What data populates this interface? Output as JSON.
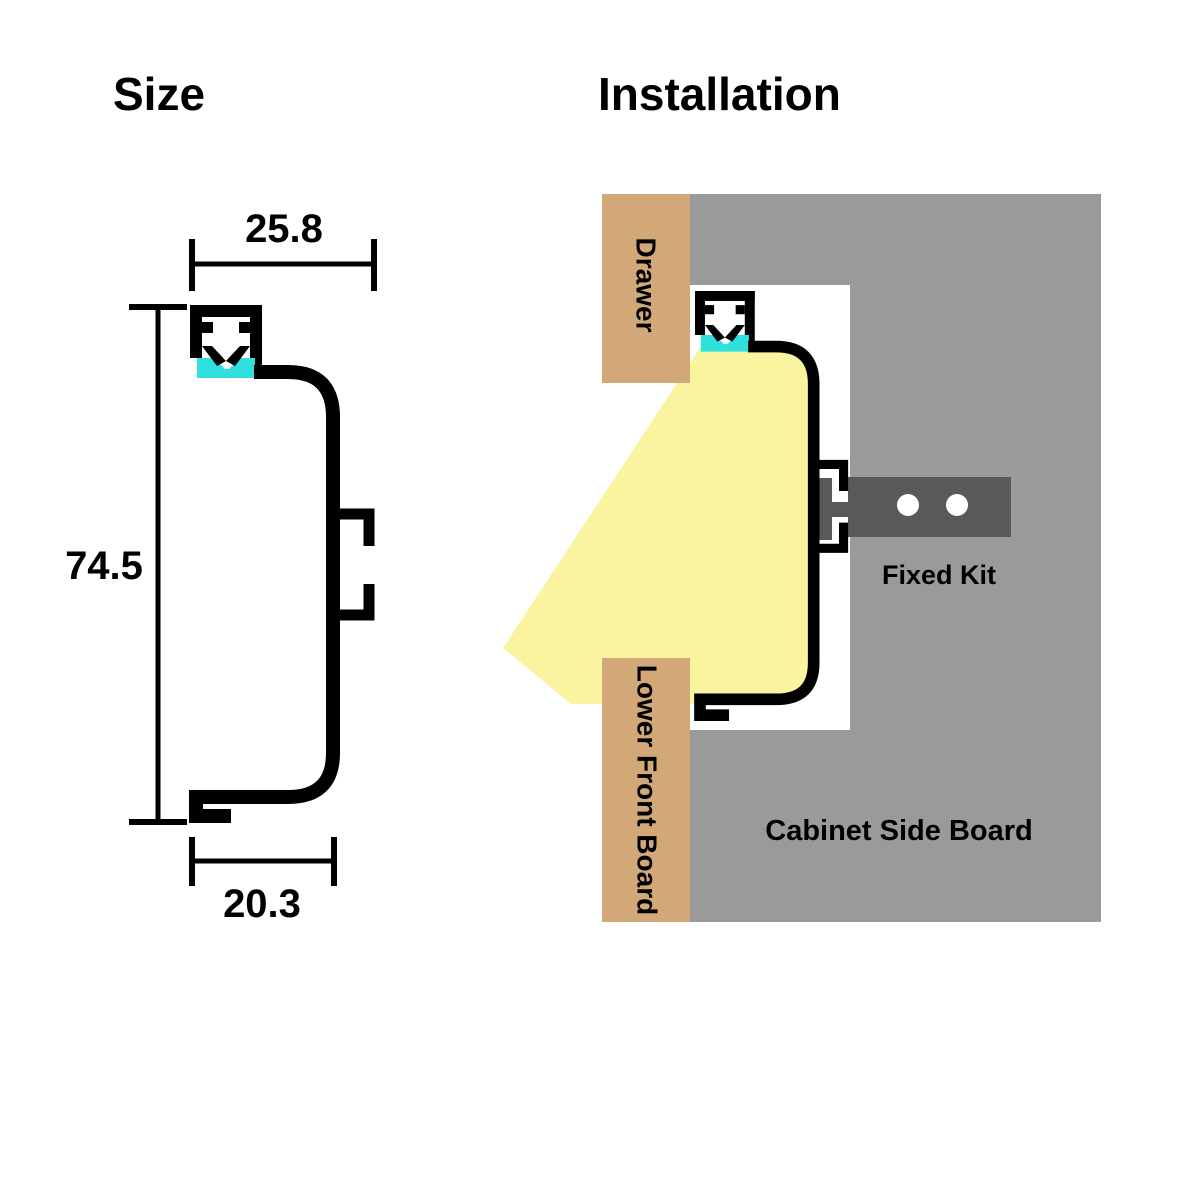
{
  "size_panel": {
    "title": "Size",
    "dim_top": "25.8",
    "dim_left": "74.5",
    "dim_bottom": "20.3"
  },
  "installation_panel": {
    "title": "Installation",
    "drawer_label": "Drawer",
    "fixed_kit_label": "Fixed Kit",
    "lower_front_board_label": "Lower Front Board",
    "cabinet_side_board_label": "Cabinet Side Board"
  },
  "colors": {
    "profile_outline": "#000000",
    "led_diffuser": "#2FE0DF",
    "light_beam": "#FAF3A0",
    "wood_board": "#D2A878",
    "cabinet_board": "#9A9A9A",
    "fixed_kit": "#58595B",
    "hole": "#FFFFFF",
    "background": "#FFFFFF"
  }
}
